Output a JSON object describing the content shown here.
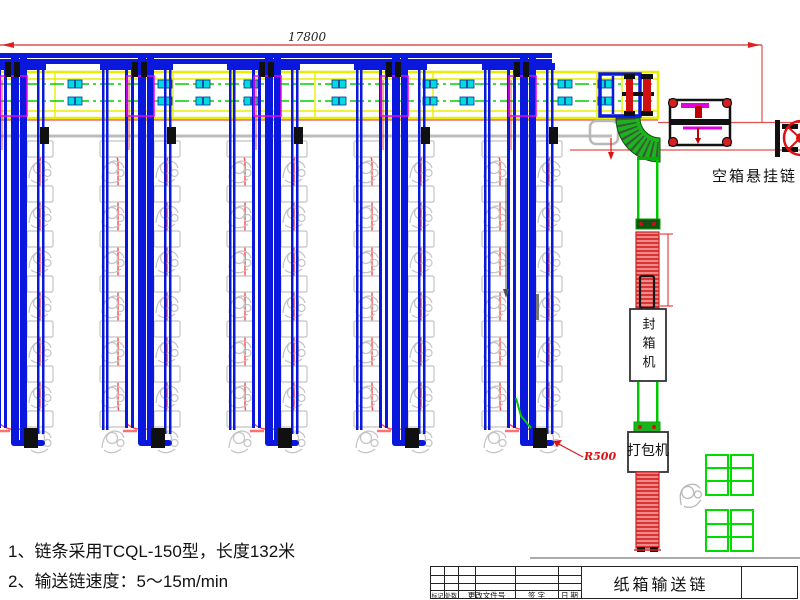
{
  "labels": {
    "dim_total": "17800",
    "empty_box_chain": "空箱悬挂链",
    "sealing_machine": "封箱机",
    "packing_machine": "打包机",
    "r500": "R500"
  },
  "notes": {
    "line1": "1、链条采用TCQL-150型，长度132米",
    "line2": "2、输送链速度：5～15m/min"
  },
  "title_block": {
    "drawing_title": "纸箱输送链",
    "col_mark": "标记",
    "col_count": "处数",
    "col_change_doc": "更改文件号",
    "col_sign": "签 字",
    "col_date": "日 期"
  },
  "colors": {
    "rail_blue": "#0a18dd",
    "band_yellow": "#e8ee00",
    "chain_green": "#00c800",
    "accent_magenta": "#ee00ee",
    "dim_red": "#e02020",
    "station_gray": "#c4c4c4",
    "sensor_cyan": "#00dcdc"
  }
}
